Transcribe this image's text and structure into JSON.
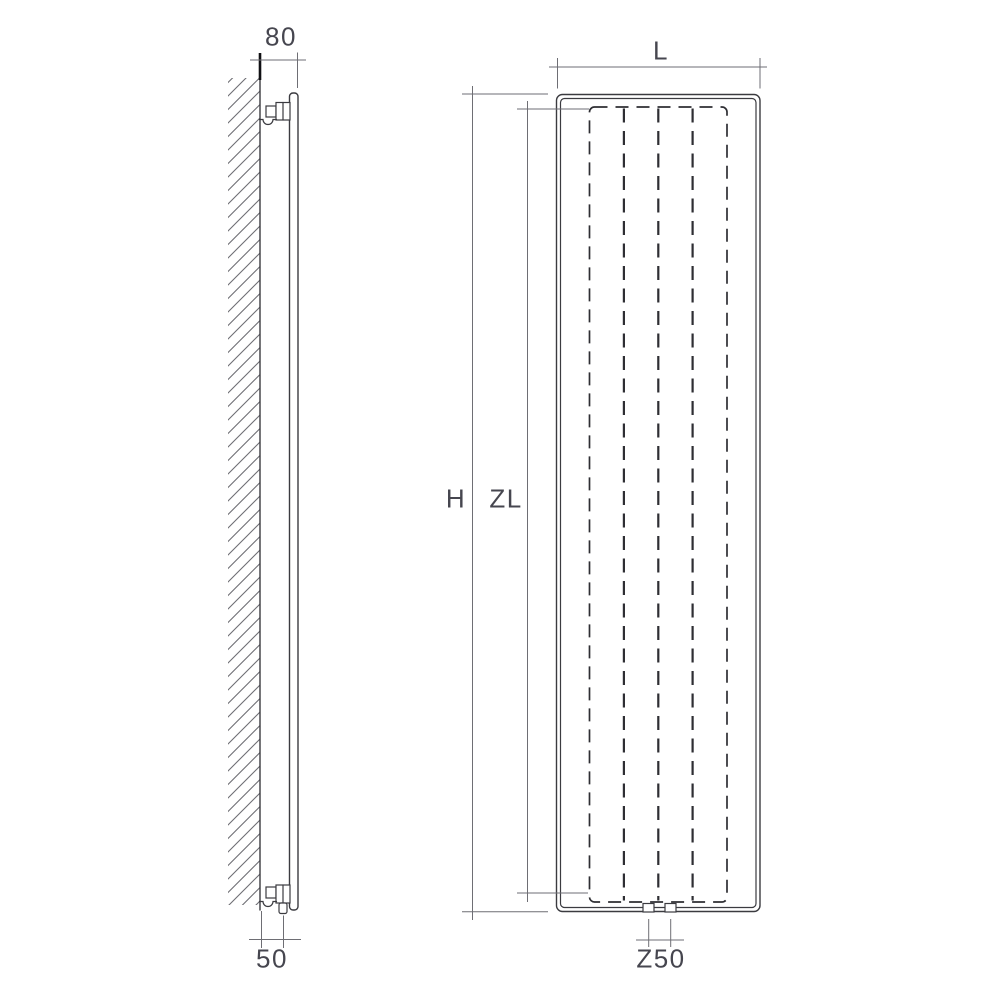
{
  "colors": {
    "bg": "#ffffff",
    "line": "#3b3b40",
    "dim": "#6e6e74",
    "hidden": "#2e2e33",
    "text": "#46464f",
    "wall_tick": "#101014"
  },
  "side_view": {
    "depth_label": "80",
    "wall_offset_label": "50"
  },
  "front_view": {
    "width_label": "L",
    "height_label": "H",
    "heated_height_label": "ZL",
    "connection_spacing_label": "Z50"
  }
}
